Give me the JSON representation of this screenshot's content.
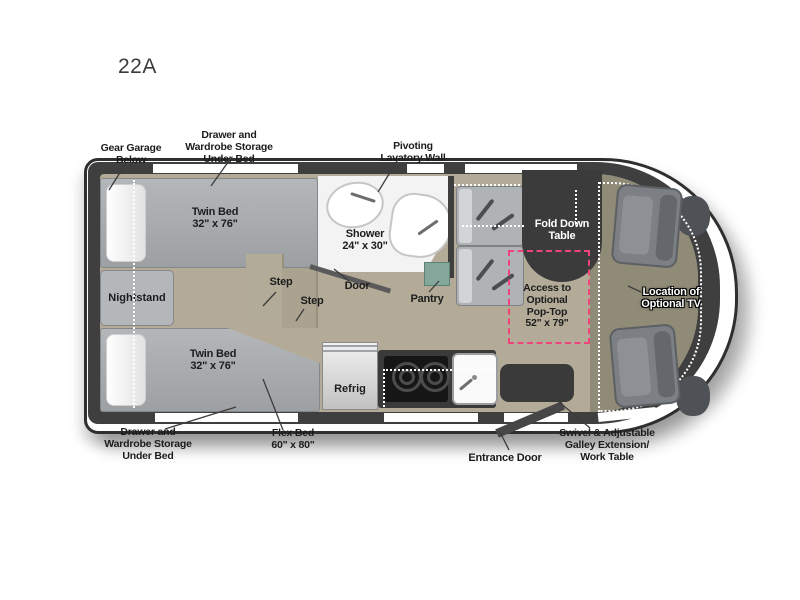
{
  "title": "22A",
  "floorplan": {
    "labels": {
      "gear_garage": "Gear Garage\nBelow",
      "drawer_storage_top": "Drawer and\nWardrobe Storage\nUnder Bed",
      "pivoting_lavatory": "Pivoting\nLavatory Wall",
      "twin_bed_top": "Twin Bed\n32\" x 76\"",
      "twin_bed_bottom": "Twin Bed\n32\" x 76\"",
      "nightstand": "Nightstand",
      "shower": "Shower\n24\" x 30\"",
      "step_upper": "Step",
      "step_lower": "Step",
      "door": "Door",
      "pantry": "Pantry",
      "refrig": "Refrig",
      "fold_down_table": "Fold Down\nTable",
      "access_pop_top": "Access to\nOptional\nPop-Top\n52\" x 79\"",
      "location_tv": "Location of\nOptional TV",
      "drawer_storage_bottom": "Drawer and\nWardrobe Storage\nUnder Bed",
      "flex_bed": "Flex Bed\n60\" x 80\"",
      "entrance_door": "Entrance Door",
      "swivel_galley": "Swivel & Adjustable\nGalley Extension/\nWork Table"
    },
    "colors": {
      "wall": "#3f3f3f",
      "floor": "#b3ab98",
      "cab_floor": "#908b77",
      "bed": "#a6a9ac",
      "pop_top_dashed": "#f0437a",
      "dark_table": "#3a3a3a",
      "pantry": "#84a79b",
      "label_text": "#1c1c1c"
    }
  }
}
